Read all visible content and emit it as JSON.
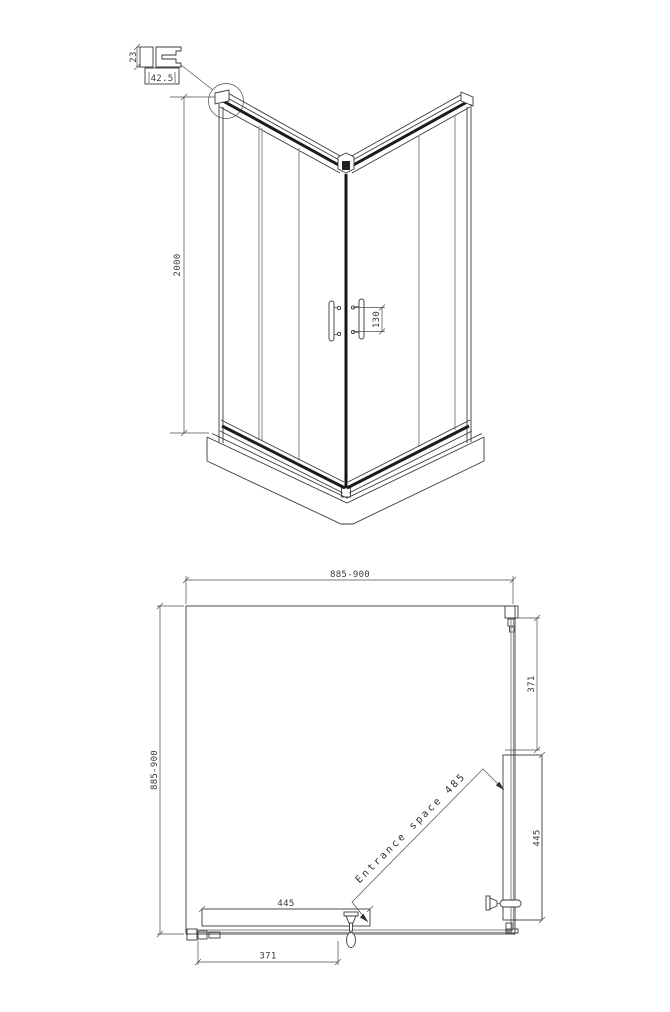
{
  "detail_callout": {
    "profile_height": "23",
    "profile_width": "42.5"
  },
  "front_view": {
    "overall_height": "2000",
    "handle_spacing": "130"
  },
  "plan_view": {
    "overall_width": "885-900",
    "overall_depth": "885-900",
    "right_fixed_panel": "371",
    "right_door_panel": "445",
    "bottom_door_panel": "445",
    "bottom_fixed_panel": "371",
    "entrance_annotation": "Entrance space 485"
  },
  "colors": {
    "line": "#3a3a3a",
    "dark_profile": "#1b1b1b",
    "glass_line": "#9a9a9a",
    "background": "#ffffff"
  }
}
